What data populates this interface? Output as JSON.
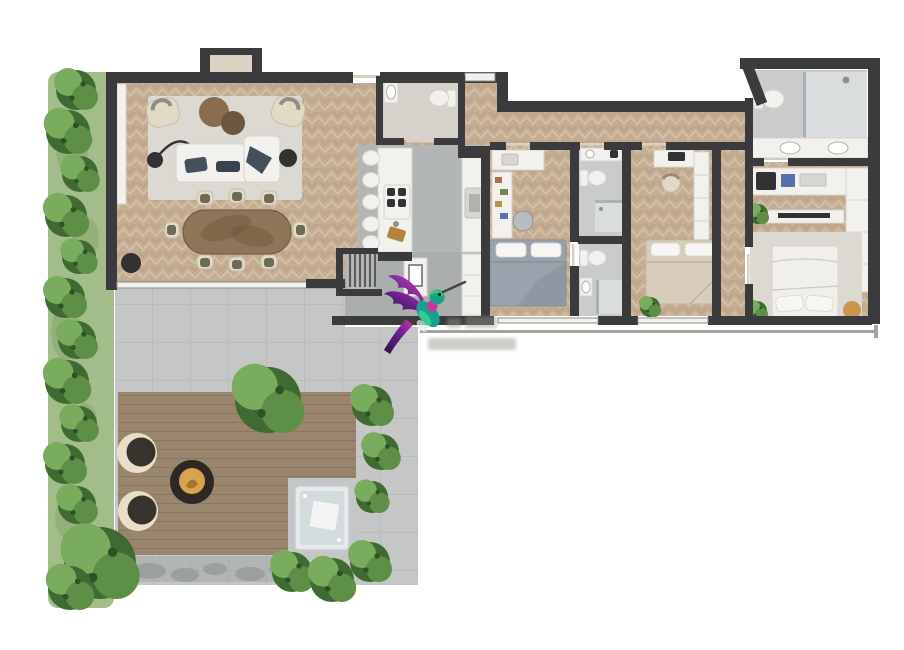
{
  "canvas": {
    "width": 904,
    "height": 650,
    "background": "#ffffff"
  },
  "watermark": {
    "logo_icon": "hummingbird-logo",
    "caption_lines": 2,
    "caption_legible": false
  },
  "floor_plan": {
    "type": "residential-apartment-with-terrace",
    "rooms": [
      {
        "name": "living-room",
        "furniture": [
          "rug",
          "sofa",
          "chaise",
          "armchair",
          "armchair",
          "coffee-table",
          "coffee-table",
          "floor-lamp",
          "side-table",
          "planter",
          "dining-table",
          "dining-chairs-8",
          "fireplace-nook"
        ]
      },
      {
        "name": "kitchen",
        "furniture": [
          "island",
          "bar-stools-5",
          "cooktop-4-burner",
          "cutting-board",
          "counter-column",
          "oven",
          "tall-cabinet"
        ]
      },
      {
        "name": "powder-room",
        "furniture": [
          "pedestal-sink",
          "toilet"
        ]
      },
      {
        "name": "entry-hall",
        "furniture": [
          "stairs",
          "console-with-art"
        ]
      },
      {
        "name": "bedroom-1",
        "furniture": [
          "double-bed-gray",
          "desk",
          "laptop",
          "shelf-unit",
          "office-chair"
        ]
      },
      {
        "name": "bathroom-1",
        "furniture": [
          "vanity",
          "toilet",
          "shower"
        ]
      },
      {
        "name": "bathroom-2",
        "furniture": [
          "toilet",
          "sink",
          "shower"
        ]
      },
      {
        "name": "bedroom-2",
        "furniture": [
          "double-bed-beige",
          "desk",
          "chair",
          "wardrobe",
          "plant"
        ]
      },
      {
        "name": "master-bathroom",
        "furniture": [
          "toilet",
          "walk-in-shower",
          "double-vanity"
        ]
      },
      {
        "name": "master-closet",
        "furniture": [
          "shelf-run",
          "safe",
          "storage-boxes",
          "wardrobe"
        ]
      },
      {
        "name": "master-bedroom",
        "furniture": [
          "king-bed",
          "tv-console",
          "rug",
          "pouf",
          "plants"
        ]
      },
      {
        "name": "terrace",
        "furniture": [
          "wood-deck",
          "lounge-chair",
          "lounge-chair",
          "fire-pit",
          "hot-tub",
          "stone-path",
          "trees-and-shrubs"
        ]
      },
      {
        "name": "garden-strip",
        "furniture": [
          "hedge-plants",
          "grass"
        ]
      }
    ]
  },
  "colors": {
    "wall": "#3b3a3c",
    "vestibule": "#ddd3c5",
    "wood-base": "#c5ad93",
    "wood-zig": "#d8c4ac",
    "wood-zig2": "#b49b81",
    "floor-gray": "#b2b6b5",
    "hall-gray": "#aaaead",
    "powder-floor": "#d6d2cb",
    "bath-tile": "#c9cccb",
    "shower-tile": "#dadddd",
    "paving": "#c5c7c6",
    "paving-line": "#b0b4b3",
    "deck": "#9a866e",
    "deck-line": "#84704f",
    "stone": "#9aa09e",
    "grass": "#a3bd8a",
    "grass-dark": "#8cab72",
    "green-dark": "#3f6b33",
    "green-mid": "#5d8f46",
    "green-light": "#7aac5e",
    "green-fleck": "#2e5226",
    "rug": "#dbd9d2",
    "white-furn": "#f2f1ed",
    "furn-stroke": "#d7d3cb",
    "dark-accent": "#323133",
    "cushion": "#46505c",
    "cushion-mid": "#39424d",
    "table-brown": "#8a6c4e",
    "table-brown-dark": "#6e5740",
    "table-wood": "#8f7557",
    "table-wood-dark": "#6d573c",
    "chair-cream": "#e3dac6",
    "chair-seat": "#6d6b55",
    "appliance": "#d8d6d2",
    "bed-gray": "#9aa3ad",
    "bed-beige": "#d8cdbb",
    "bed-white": "#f1efe9",
    "tub-shell": "#e6eaea",
    "tub-water": "#d2dcde",
    "fire-ring": "#2c2824",
    "fire-glow": "#d8a54e",
    "lounge-dark": "#36332d",
    "lounge-cream": "#e9dfc9",
    "glass": "#a9b2b4",
    "window-fill": "#f2f1ee",
    "window-stroke": "#8f8b85",
    "door-leaf": "#d9d2c4",
    "balcony": "#a5a19b",
    "pouf": "#c9954f",
    "board": "#b5833f",
    "accent-blue": "#5b6fb0",
    "accent-red": "#b06a4a",
    "accent-olive": "#77894f",
    "accent-gold": "#b8923f",
    "watermark": "#97938c",
    "office-chair": "#b9bcbf",
    "stairs-floor": "#b7bab9",
    "bird-teal": "#17a18c",
    "bird-mint": "#3ed29b",
    "bird-green": "#35d06e",
    "bird-purple": "#6d2390",
    "bird-magenta": "#c8379f",
    "bird-deep": "#3d1460",
    "bird-beak": "#4a4547"
  }
}
